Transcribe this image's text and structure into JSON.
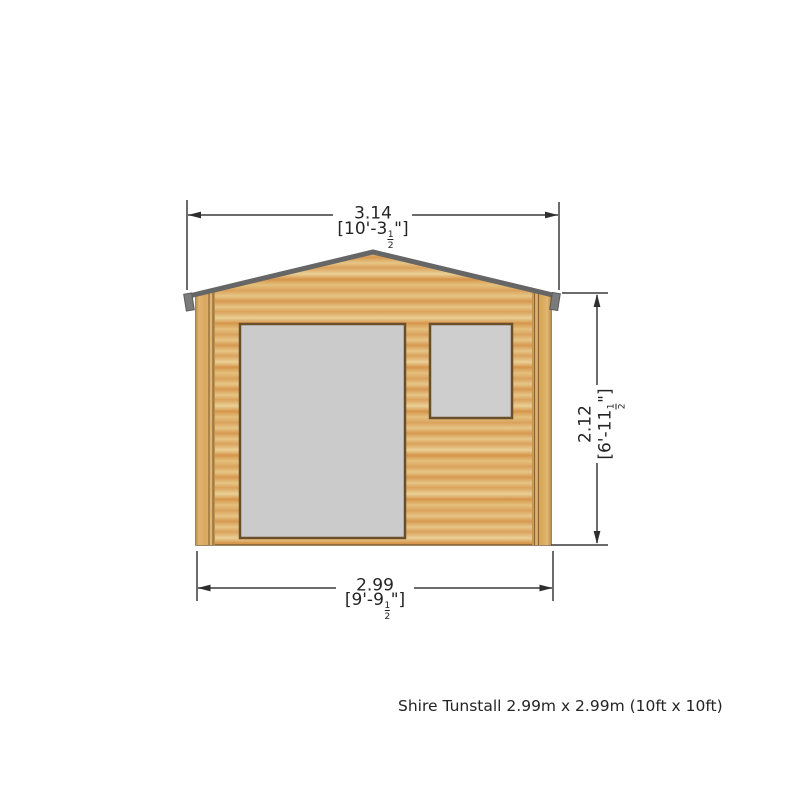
{
  "caption": {
    "text": "Shire Tunstall 2.99m x 2.99m (10ft x 10ft)"
  },
  "dimensions": {
    "overall_width": {
      "metric_m": "3.14",
      "imperial_prefix": "[10'-3",
      "fraction_numerator": "1",
      "fraction_denominator": "2",
      "imperial_suffix": "\"]"
    },
    "wall_height": {
      "metric_m": "2.12",
      "imperial_prefix": "[6'-11",
      "fraction_numerator": "1",
      "fraction_denominator": "2",
      "imperial_suffix": "\"]"
    },
    "base_width": {
      "metric_m": "2.99",
      "imperial_prefix": "[9'-9",
      "fraction_numerator": "1",
      "fraction_denominator": "2",
      "imperial_suffix": "\"]"
    }
  },
  "drawing": {
    "colors": {
      "wood_light": "#e6c686",
      "wood_dark": "#d6954a",
      "post_wood": "#dcae66",
      "roof_fascia": "#666666",
      "opening_fill": "#cccccc",
      "opening_border": "#6b4f2a",
      "dimension_line": "#3a3a3a",
      "text": "#242424",
      "background": "#ffffff"
    }
  }
}
